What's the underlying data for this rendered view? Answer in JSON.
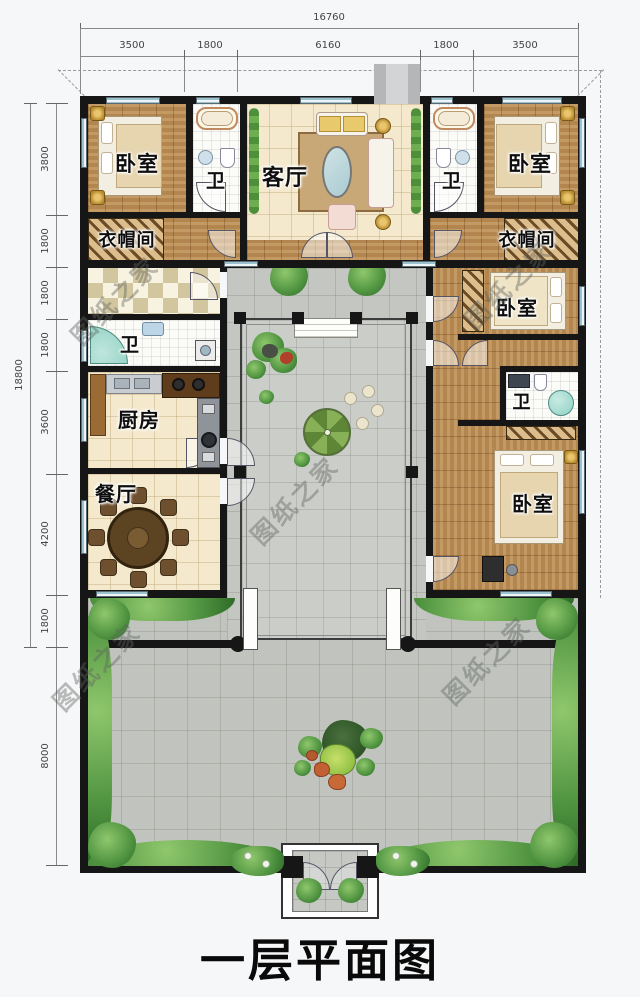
{
  "title": "一层平面图",
  "watermark": "图纸之家",
  "dimensions": {
    "top": {
      "total": "16760",
      "segments": [
        "3500",
        "1800",
        "6160",
        "1800",
        "3500"
      ]
    },
    "left": {
      "total": "18800",
      "segments": [
        "3800",
        "1800",
        "1800",
        "1800",
        "3600",
        "4200",
        "1800",
        "8000"
      ]
    }
  },
  "rooms": [
    {
      "id": "bedroom-top-left",
      "label": "卧室"
    },
    {
      "id": "bath-top-left",
      "label": "卫"
    },
    {
      "id": "living-room",
      "label": "客厅"
    },
    {
      "id": "bath-top-right",
      "label": "卫"
    },
    {
      "id": "bedroom-top-right",
      "label": "卧室"
    },
    {
      "id": "cloakroom-left",
      "label": "衣帽间"
    },
    {
      "id": "cloakroom-right",
      "label": "衣帽间"
    },
    {
      "id": "bath-west",
      "label": "卫"
    },
    {
      "id": "kitchen",
      "label": "厨房"
    },
    {
      "id": "dining-room",
      "label": "餐厅"
    },
    {
      "id": "bedroom-east-1",
      "label": "卧室"
    },
    {
      "id": "bath-east",
      "label": "卫"
    },
    {
      "id": "bedroom-east-2",
      "label": "卧室"
    }
  ],
  "colors": {
    "wall": "#161616",
    "wood_floor": "#bd8e53",
    "tile_cream": "#f4e9cd",
    "courtyard": "#c4c7c1",
    "greenery": "#4f9340",
    "window": "#9cc2cf",
    "title_text": "#0a0a0a"
  }
}
